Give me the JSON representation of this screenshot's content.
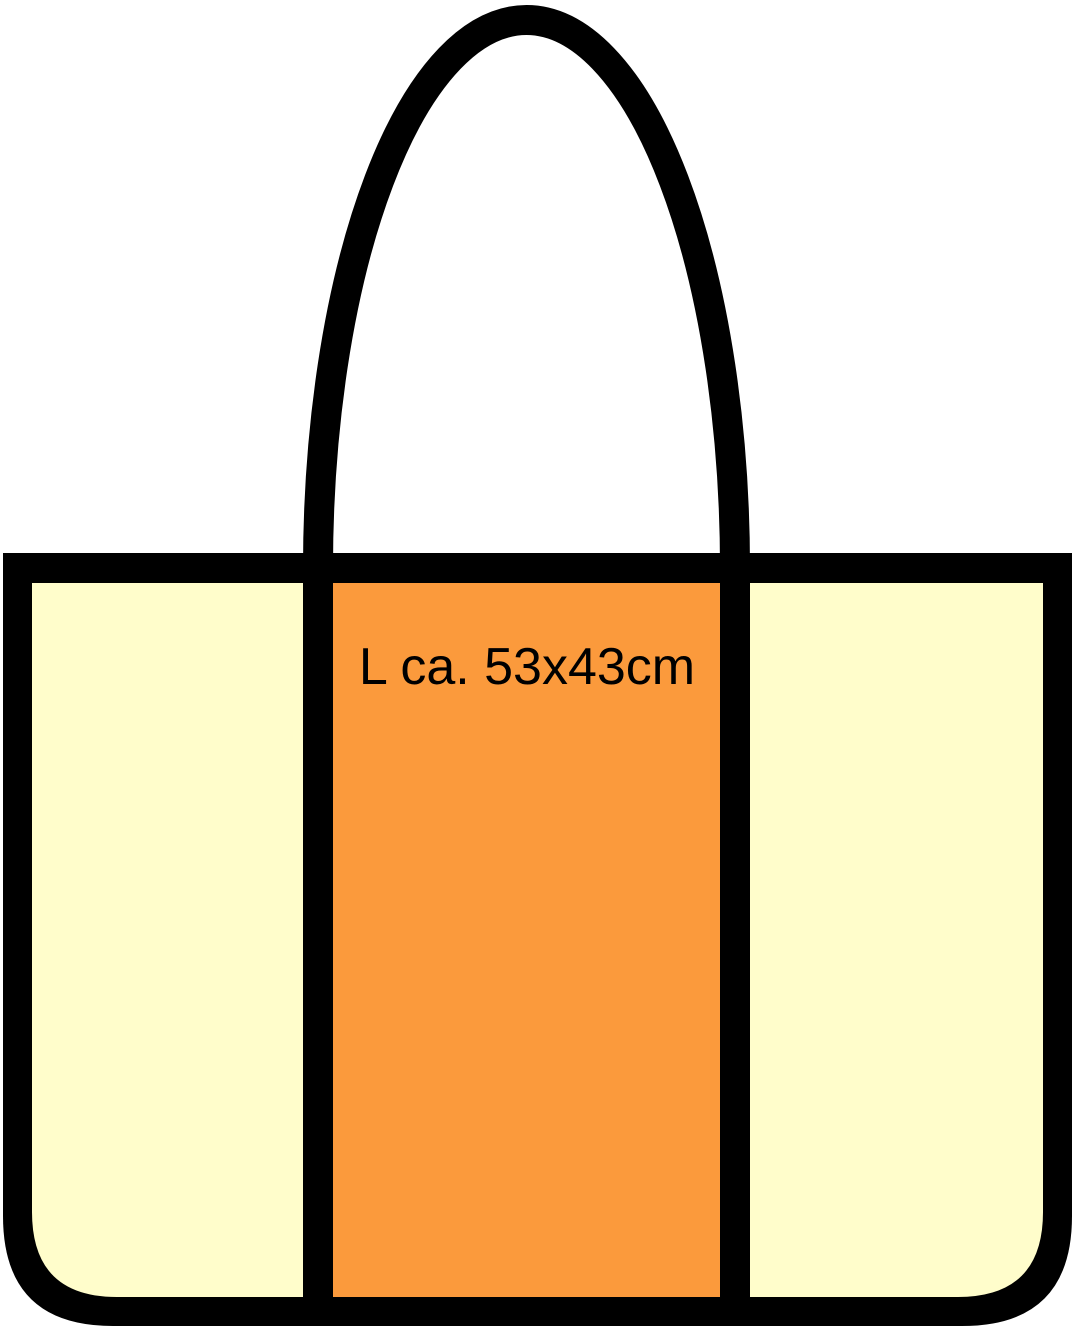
{
  "illustration": {
    "name": "tote-bag-size-diagram",
    "label": "L ca. 53x43cm",
    "colors": {
      "outline": "#000000",
      "side_panel": "#FFFDCB",
      "center_panel": "#FB9A3C",
      "label_text": "#000000",
      "background": "#FFFFFF"
    }
  }
}
